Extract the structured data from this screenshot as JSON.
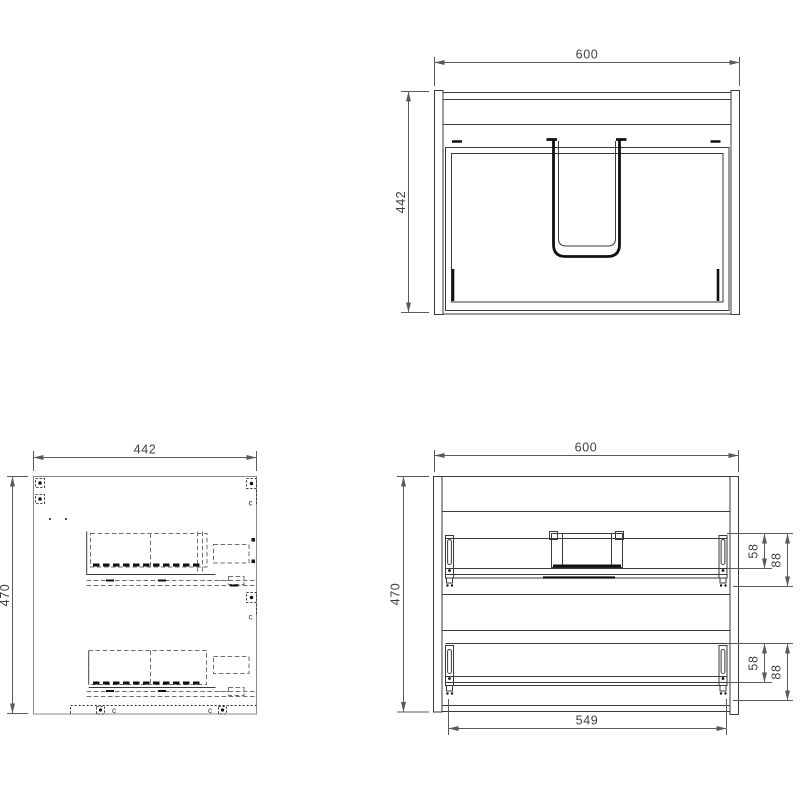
{
  "views": {
    "front": {
      "dim_width": "600",
      "dim_height": "442"
    },
    "side": {
      "dim_width": "442",
      "dim_height": "470",
      "hardware_mark": "c"
    },
    "internal": {
      "dim_width": "600",
      "dim_height": "470",
      "dim_slide_span": "549",
      "upper_rail": {
        "dim_rail": "58",
        "dim_clearance": "88"
      },
      "lower_rail": {
        "dim_rail": "58",
        "dim_clearance": "88"
      }
    }
  },
  "colors": {
    "line_dark": "#3a3a3a",
    "line_gray": "#8a8a8a",
    "dimension": "#5a5a5a",
    "detail_black": "#101010",
    "background": "#ffffff"
  }
}
